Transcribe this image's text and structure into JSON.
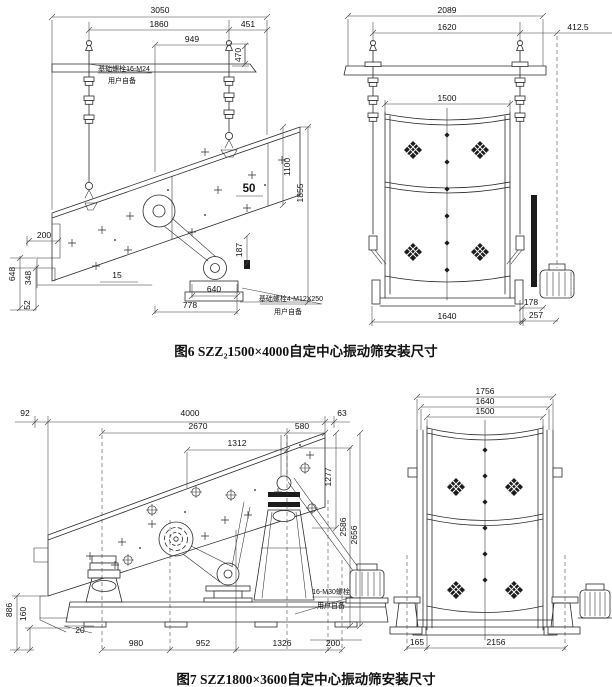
{
  "colors": {
    "line": "#2b2b2b",
    "dim": "#3c3c3c",
    "dark_fill": "#1c1c1c",
    "background": "#ffffff"
  },
  "figure6": {
    "caption": "图6 SZZ₂1500×4000自定中心振动筛安装尺寸",
    "side": {
      "d3050": "3050",
      "d1860": "1860",
      "d451": "451",
      "d949": "949",
      "d470": "470",
      "d50": "50",
      "d187": "187",
      "d1100": "1100",
      "d1855": "1855",
      "d200": "200",
      "d648": "648",
      "d348": "348",
      "d52": "52",
      "d15": "15",
      "d640": "640",
      "d778": "778",
      "note_bolt_top": "基础螺栓16-M24",
      "note_user_top": "用户自备",
      "note_bolt_bottom": "基础螺栓4-M12X250",
      "note_user_bottom": "用户自备"
    },
    "front": {
      "d2089": "2089",
      "d1620": "1620",
      "d412_5": "412.5",
      "d1500": "1500",
      "d1640": "1640",
      "d178": "178",
      "d257": "257"
    }
  },
  "figure7": {
    "caption": "图7 SZZ1800×3600自定中心振动筛安装尺寸",
    "side": {
      "d92": "92",
      "d4000": "4000",
      "d63": "63",
      "d2670": "2670",
      "d580": "580",
      "d1312": "1312",
      "d1277": "1277",
      "d2586": "2586",
      "d2656": "2656",
      "d886": "886",
      "d160": "160",
      "d20": "20",
      "d980": "980",
      "d952": "952",
      "d1326": "1326",
      "d200": "200",
      "note_bolt": "16-M30螺栓",
      "note_user": "用户自备"
    },
    "front": {
      "d1756": "1756",
      "d1640": "1640",
      "d1500": "1500",
      "d165": "165",
      "d2156": "2156"
    }
  }
}
